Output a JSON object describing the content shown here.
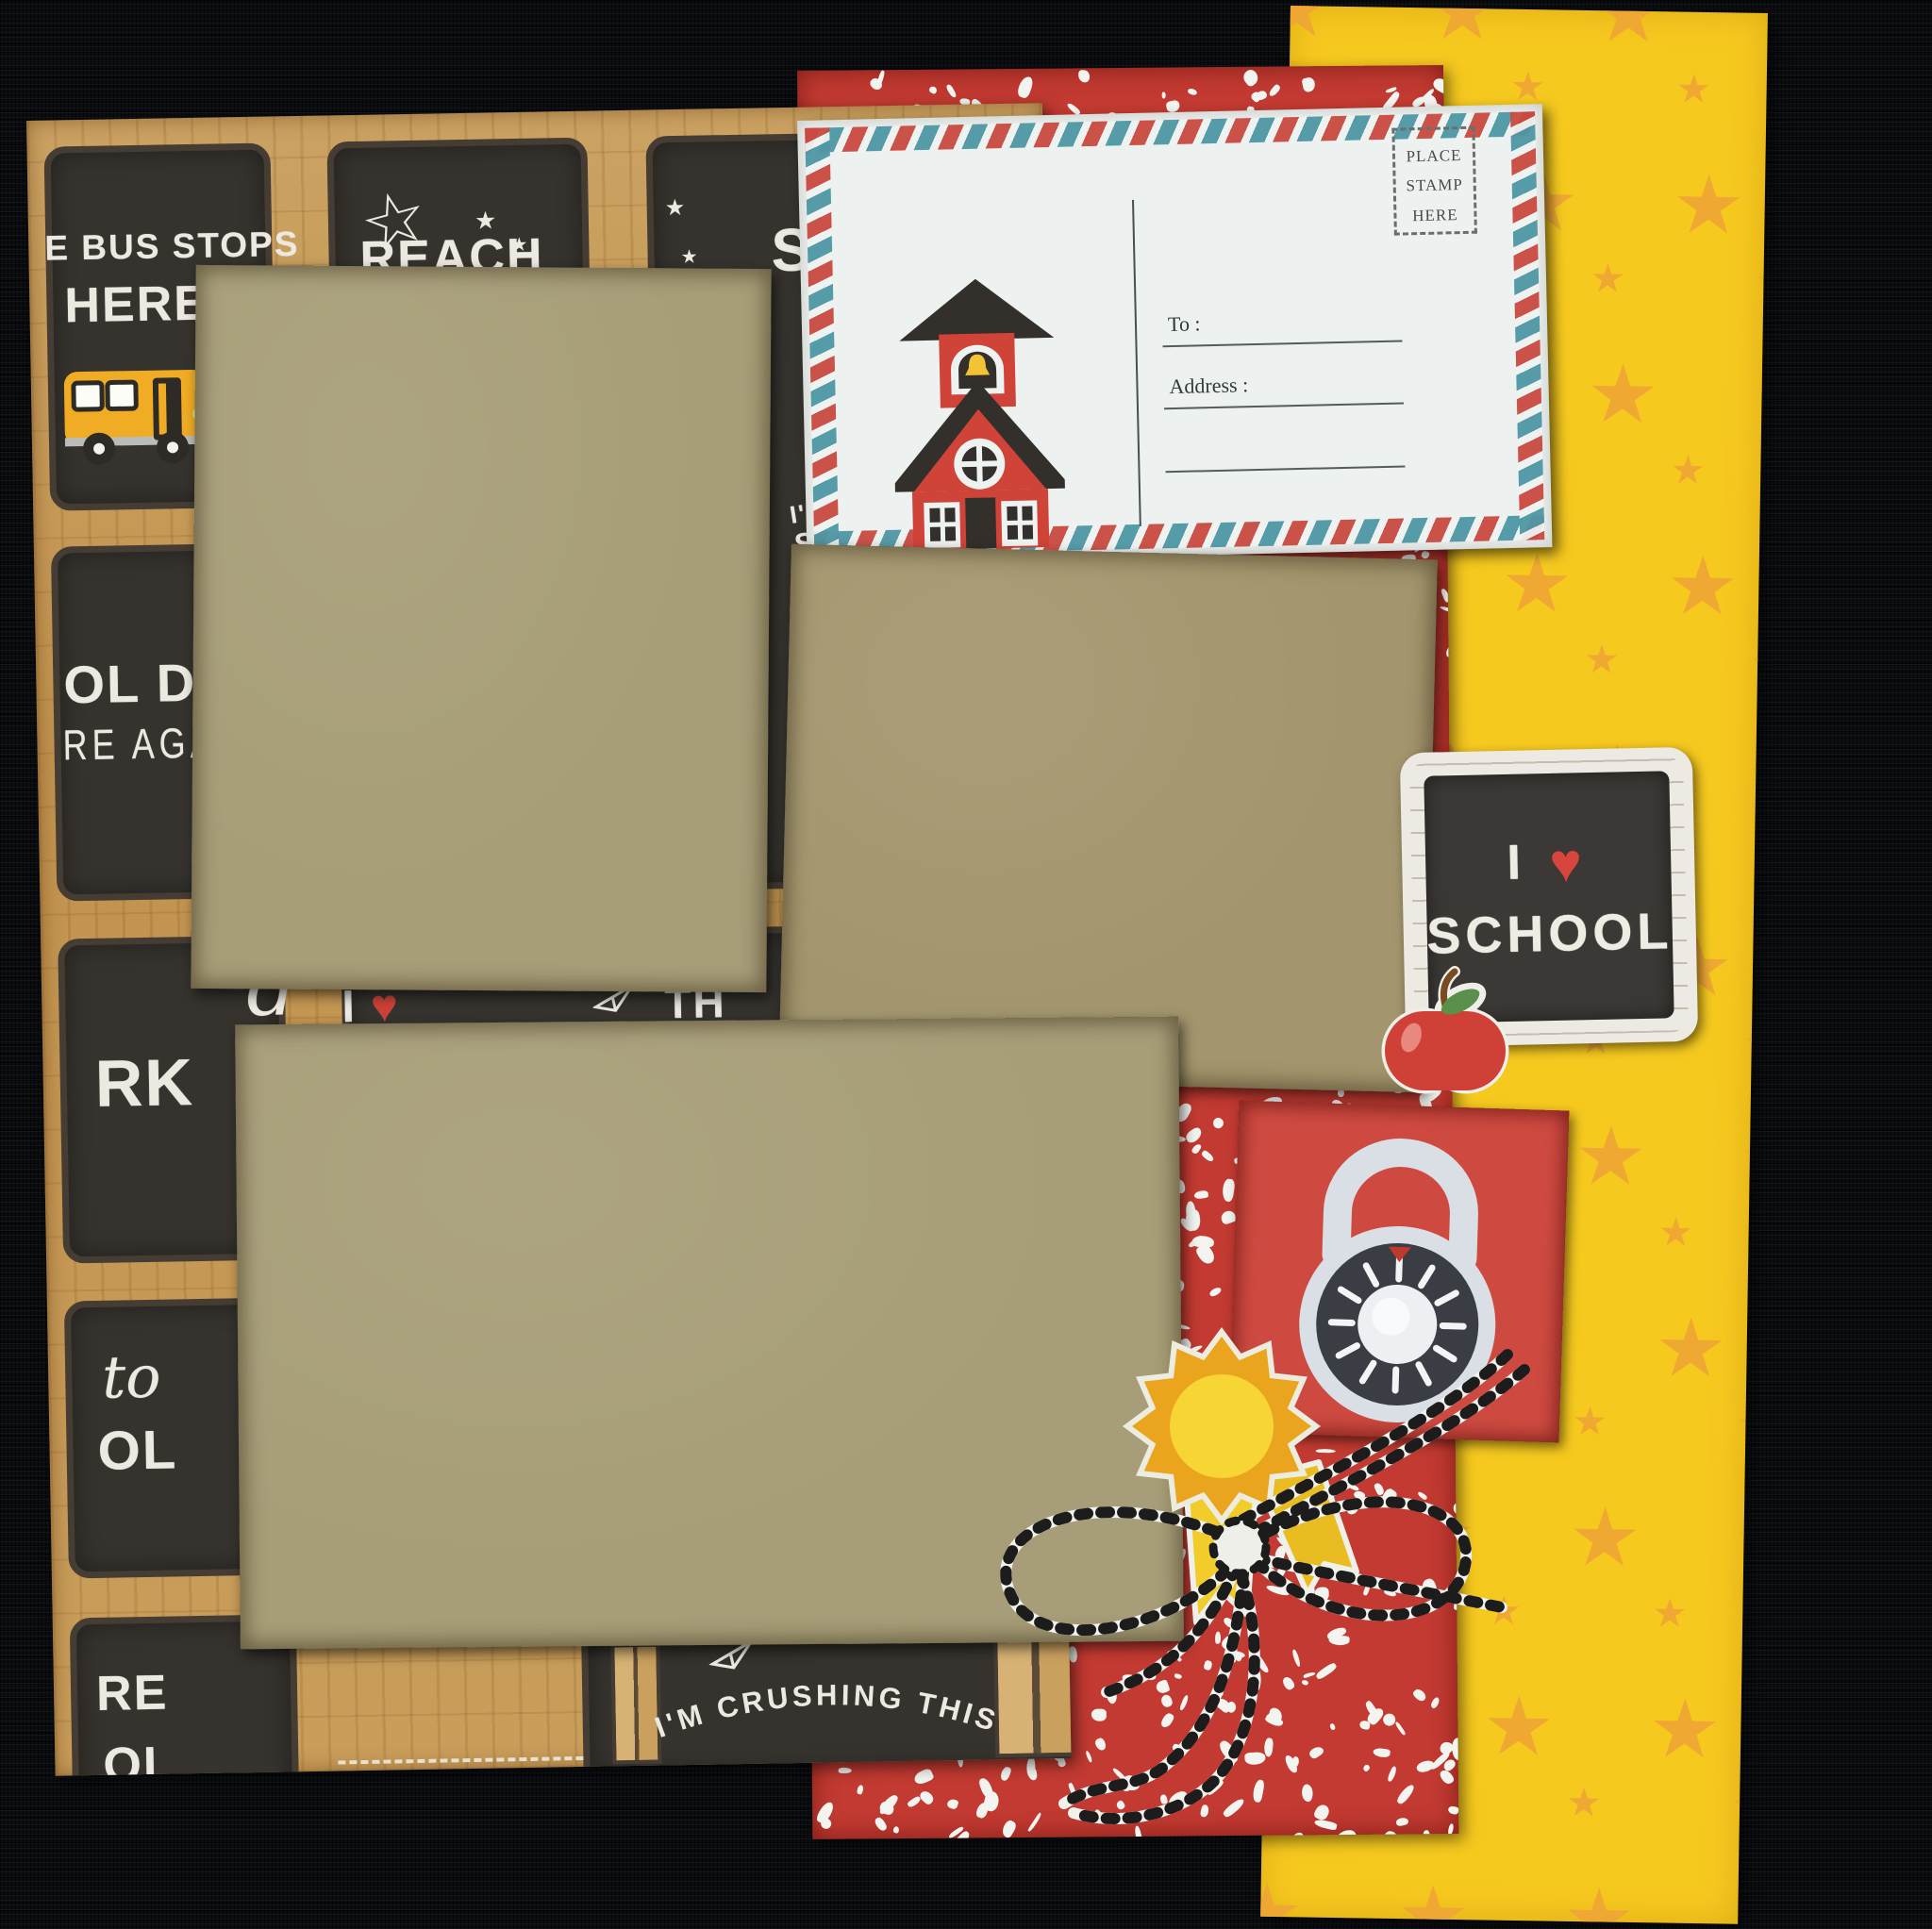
{
  "left_paper": {
    "bus_panel": {
      "line1": "E BUS STOPS",
      "line2": "HERE"
    },
    "reach_panel": {
      "line1": "REACH",
      "line2": "FOR THE"
    },
    "s_panel": {
      "letter": "S"
    },
    "days_panel": {
      "line1": "OL DAYS",
      "line2": "RE AGAIN"
    },
    "work_panel": {
      "script": "d",
      "caps": "RK"
    },
    "school_panel": {
      "script": "to",
      "caps": "OL"
    },
    "here_panel": {
      "caps1": "RE",
      "caps2": "OL"
    },
    "partial_phrase": {
      "word1": "I",
      "heart": "♥",
      "word2": "TH"
    },
    "partial_letters": {
      "line1": "I'",
      "line2": "SI"
    },
    "banner": "I'M CRUSHING THIS"
  },
  "postcard": {
    "stamp_line1": "PLACE",
    "stamp_line2": "STAMP",
    "stamp_line3": "HERE",
    "to_label": "To :",
    "address_label": "Address :"
  },
  "school_sticker": {
    "word_i": "I",
    "heart": "♥",
    "word_school": "SCHOOL"
  },
  "pattern": {
    "star": "★",
    "sparkle": "✦",
    "outline_star": "☆"
  },
  "colors": {
    "canvas_black": "#0b0d11",
    "chalk_panel": "#36332e",
    "wood_frame": "#c79a58",
    "kraft_mat": "#a79d78",
    "composition_red": "#c23a31",
    "lock_card_red": "#ce4a41",
    "star_paper_yellow": "#f6c91f",
    "star_orange": "#efa636",
    "postcard_white": "#edf1ef",
    "airmail_red": "#c94a40",
    "airmail_teal": "#4e97a4",
    "chalk_text": "#ece9e1",
    "heart_red": "#d8453c",
    "badge_orange": "#eaa41d",
    "badge_yellow": "#f6d534"
  }
}
